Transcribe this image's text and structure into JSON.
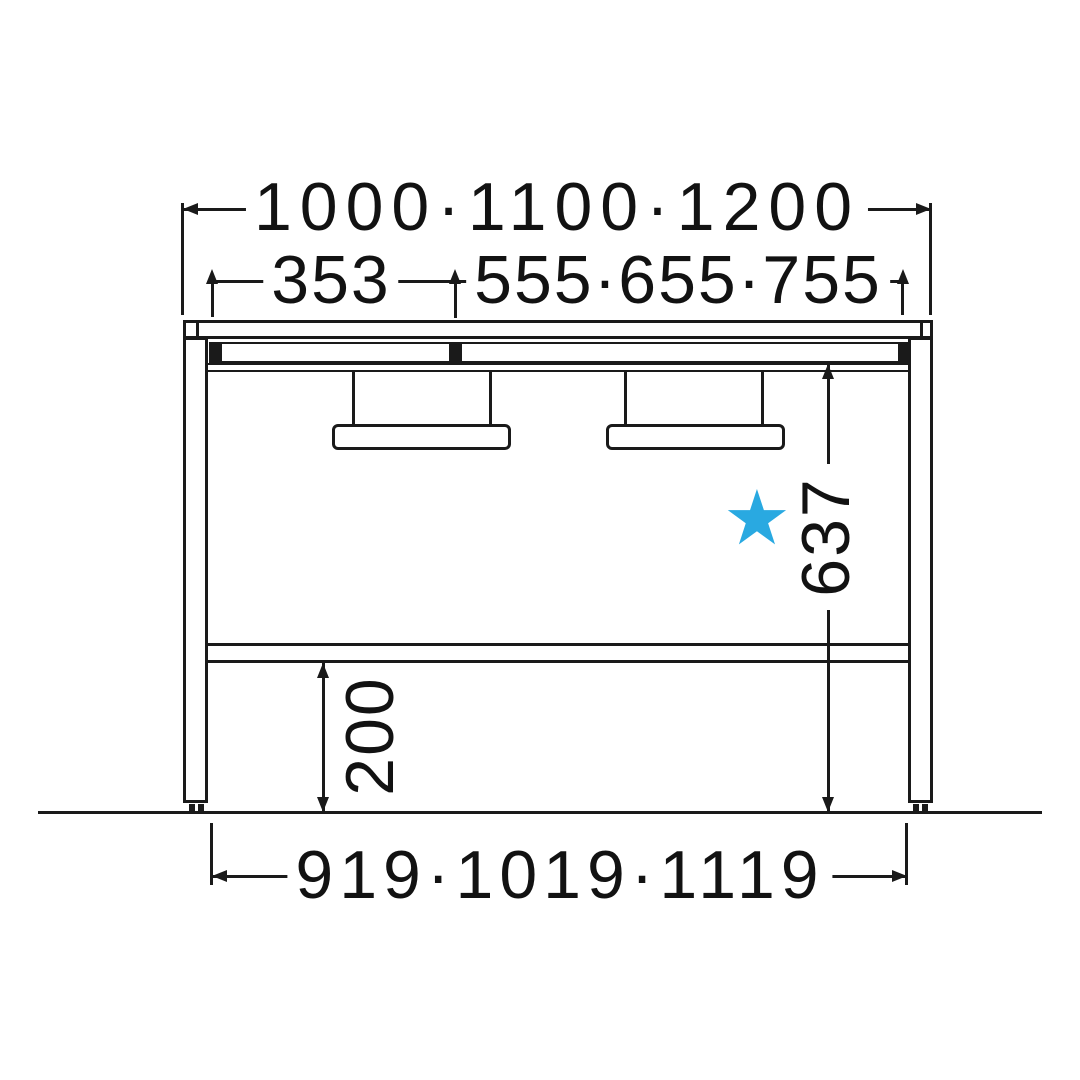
{
  "diagram": {
    "kind": "furniture dimension drawing",
    "view": "desk front elevation with hanging brackets and dimension lines"
  },
  "labels": {
    "overall_width": "1000·1100·1200",
    "left_span": "353",
    "right_span": "555·655·755",
    "underside_height": "637",
    "base_clearance": "200",
    "inner_width": "919·1019·1119"
  },
  "star": {
    "glyph": "★",
    "color": "#29A9E1"
  },
  "colors": {
    "line": "#1a1a1a",
    "background": "#ffffff"
  }
}
